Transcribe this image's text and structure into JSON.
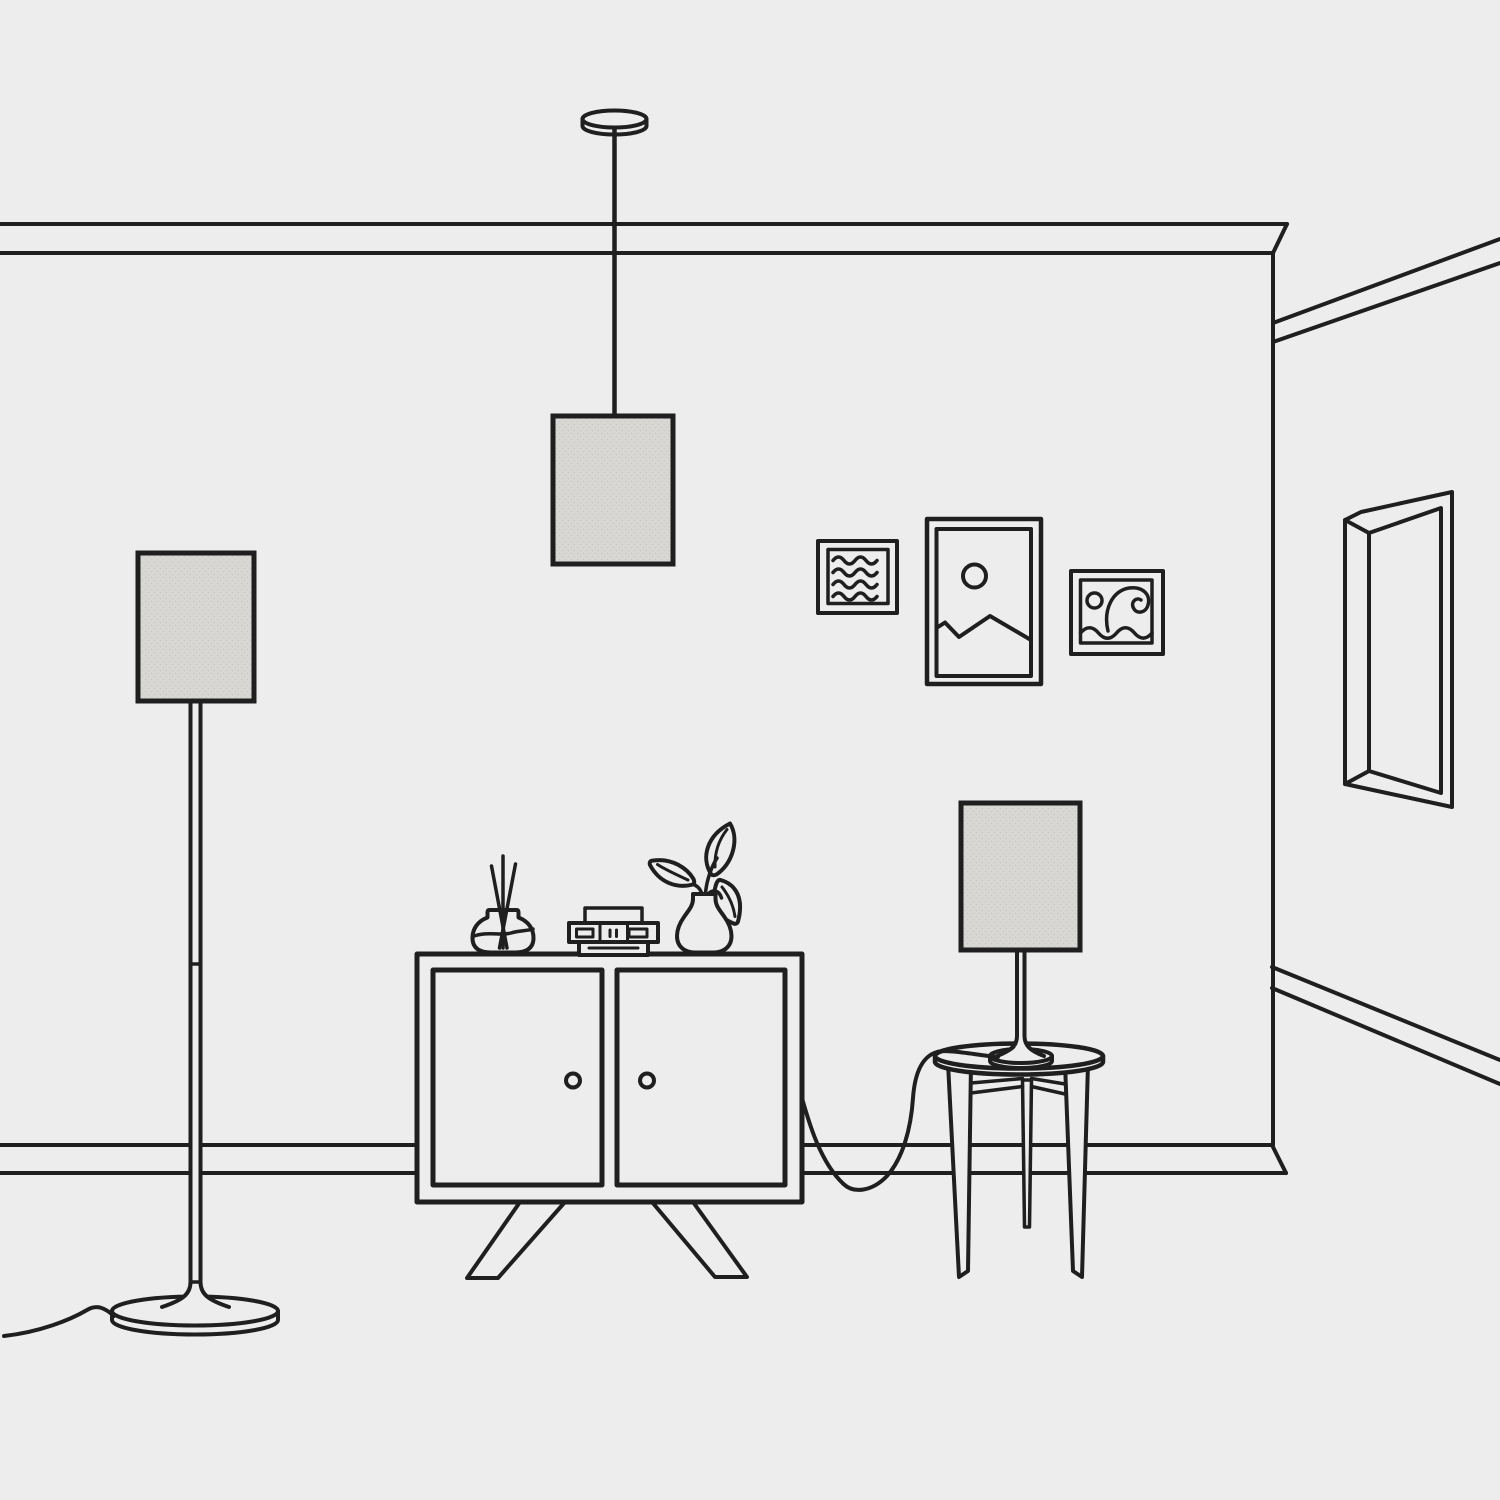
{
  "scene": {
    "title": "Minimal line-art living room illustration",
    "objects": [
      {
        "name": "crown-molding",
        "label": "Crown molding"
      },
      {
        "name": "baseboard",
        "label": "Baseboard"
      },
      {
        "name": "pendant-lamp",
        "label": "Pendant lamp with fabric shade"
      },
      {
        "name": "floor-lamp",
        "label": "Floor lamp with fabric shade"
      },
      {
        "name": "table-lamp",
        "label": "Table lamp with fabric shade"
      },
      {
        "name": "cabinet",
        "label": "Two-door cabinet with splayed legs"
      },
      {
        "name": "side-table",
        "label": "Round three-leg side table"
      },
      {
        "name": "frame-waves",
        "label": "Small wall frame with wavy lines"
      },
      {
        "name": "frame-mountain",
        "label": "Portrait wall frame with sun and mountains"
      },
      {
        "name": "frame-swirl",
        "label": "Small wall frame with wave swirl"
      },
      {
        "name": "wall-mirror",
        "label": "Tall mirror on side wall"
      },
      {
        "name": "reed-diffuser",
        "label": "Reed diffuser with sticks"
      },
      {
        "name": "book-stack",
        "label": "Stack of books and boxes"
      },
      {
        "name": "plant-vase",
        "label": "Vase with leafy plant"
      },
      {
        "name": "floor-lamp-cord",
        "label": "Floor lamp power cord"
      },
      {
        "name": "table-lamp-cord",
        "label": "Table lamp power cord"
      }
    ]
  },
  "colors": {
    "bg": "#ededed",
    "line": "#1f1f1f",
    "shade": "#d8d7d3",
    "dot": "#cbcac6"
  }
}
